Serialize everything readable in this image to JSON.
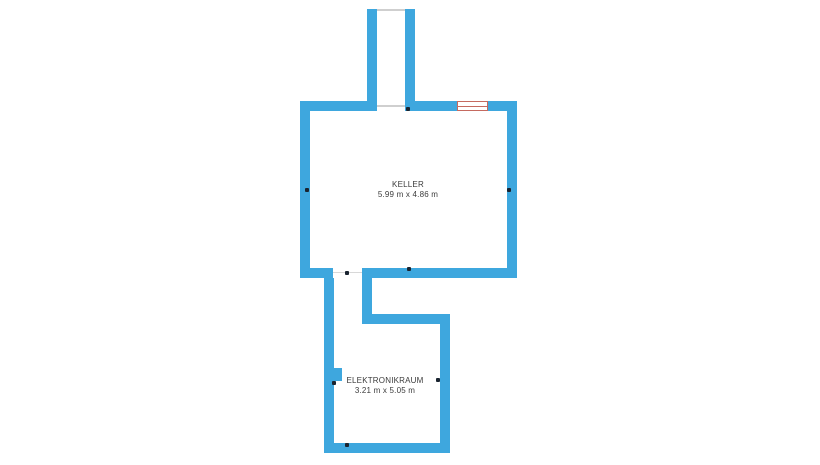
{
  "plan": {
    "rooms": [
      {
        "name": "KELLER",
        "dimensions": "5.99 m x 4.86 m"
      },
      {
        "name": "ELEKTRONIKRAUM",
        "dimensions": "3.21 m x 5.05 m"
      }
    ],
    "features": {
      "window_count": 1,
      "door_opening_count": 2,
      "point_marker_count": 8
    },
    "colors": {
      "wall": "#3EA7DE",
      "window_frame": "#C56A60",
      "marker": "#1A2430",
      "threshold_line": "#CFCFCF",
      "label_text": "#3B3B3B",
      "background": "#FFFFFF"
    }
  }
}
